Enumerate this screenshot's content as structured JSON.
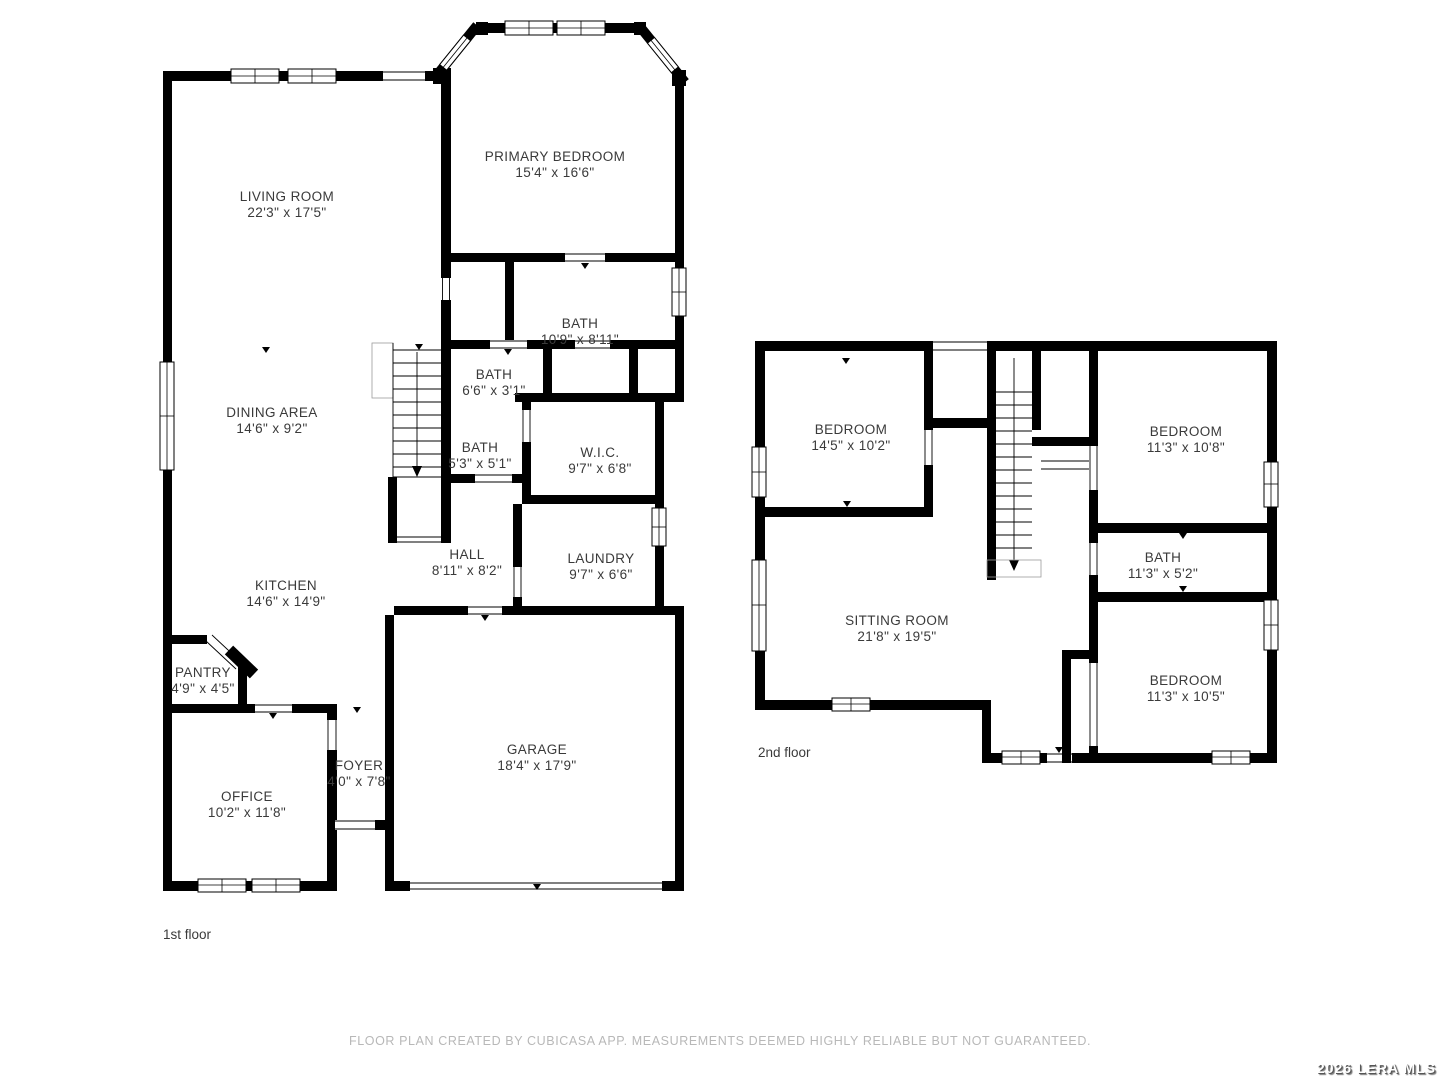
{
  "colors": {
    "wall": "#000000",
    "label": "#3a3a3a",
    "footer_text": "#b8b8b8",
    "watermark_text": "#ffffff"
  },
  "footer": {
    "disclaimer": "FLOOR PLAN CREATED BY CUBICASA APP. MEASUREMENTS DEEMED HIGHLY RELIABLE BUT NOT GUARANTEED."
  },
  "watermark": {
    "text": "2026 LERA MLS"
  },
  "floors": [
    {
      "label": "1st floor",
      "rooms": [
        {
          "name": "LIVING ROOM",
          "dims": "22'3\" x 17'5\""
        },
        {
          "name": "PRIMARY BEDROOM",
          "dims": "15'4\" x 16'6\""
        },
        {
          "name": "BATH",
          "dims": "10'9\" x 8'11\""
        },
        {
          "name": "BATH",
          "dims": "6'6\" x 3'1\""
        },
        {
          "name": "DINING AREA",
          "dims": "14'6\" x 9'2\""
        },
        {
          "name": "BATH",
          "dims": "5'3\" x 5'1\""
        },
        {
          "name": "W.I.C.",
          "dims": "9'7\" x 6'8\""
        },
        {
          "name": "HALL",
          "dims": "8'11\" x 8'2\""
        },
        {
          "name": "LAUNDRY",
          "dims": "9'7\" x 6'6\""
        },
        {
          "name": "KITCHEN",
          "dims": "14'6\" x 14'9\""
        },
        {
          "name": "PANTRY",
          "dims": "4'9\" x 4'5\""
        },
        {
          "name": "OFFICE",
          "dims": "10'2\" x 11'8\""
        },
        {
          "name": "FOYER",
          "dims": "4'0\" x 7'8\""
        },
        {
          "name": "GARAGE",
          "dims": "18'4\" x 17'9\""
        }
      ]
    },
    {
      "label": "2nd floor",
      "rooms": [
        {
          "name": "BEDROOM",
          "dims": "14'5\" x 10'2\""
        },
        {
          "name": "BEDROOM",
          "dims": "11'3\" x 10'8\""
        },
        {
          "name": "BATH",
          "dims": "11'3\" x 5'2\""
        },
        {
          "name": "SITTING ROOM",
          "dims": "21'8\" x 19'5\""
        },
        {
          "name": "BEDROOM",
          "dims": "11'3\" x 10'5\""
        }
      ]
    }
  ]
}
